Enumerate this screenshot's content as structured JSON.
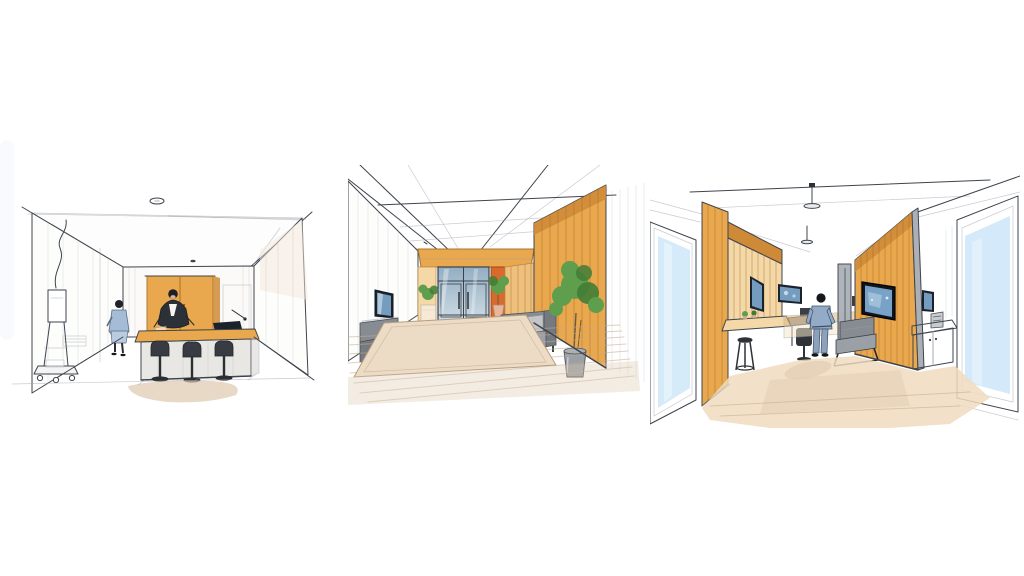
{
  "artwork": {
    "type": "hand-drawn interior concept sketch triptych",
    "medium": "ink line drawing with watercolor wash",
    "background": "#ffffff",
    "panels": [
      {
        "name": "consultation-room",
        "elements": [
          "recessed ceiling light",
          "orange wall cabinet",
          "wood-top reception desk",
          "three dark bar stools",
          "seated person in dark jacket",
          "standing visitor in blue coat",
          "mobile equipment stand with wheels and cable",
          "warm floor shadow wash"
        ]
      },
      {
        "name": "entrance-lobby",
        "elements": [
          "one-point ceiling grid",
          "wood entry portal",
          "blue glass double door",
          "orange accent panel",
          "orange wood feature wall",
          "wall-mounted tv",
          "gray bench",
          "side table",
          "pedestal plant",
          "floor plant",
          "gray sofa with white cushions",
          "tall potted plant",
          "beige area rug",
          "wood plank floor"
        ]
      },
      {
        "name": "gallery-corridor",
        "elements": [
          "left window with sky wash",
          "wood pillar",
          "slat wall with inset screen",
          "counter with stool",
          "desk with chair",
          "back-wall display screen",
          "wood credenza",
          "gray door pillar",
          "right wood slat wall",
          "large wall display",
          "small framed display",
          "gray bench",
          "white cabinet with device",
          "right window with sky wash",
          "two pendant lights",
          "walking person in blue",
          "beige floor wash with cast shadow"
        ]
      }
    ]
  },
  "colors": {
    "ink": "#3f444d",
    "wood_orange": "#e9a84e",
    "wood_deep": "#cf8a38",
    "wood_light": "#eec07e",
    "wood_pale": "#f4d8a8",
    "accent_orange": "#d96a2e",
    "floor_beige": "#f0dcbe",
    "floor_stroke": "#c9ab8c",
    "rug_beige": "#ecdcc5",
    "glass_blue": "#a3bccd",
    "sky_blue": "#cfe8f9",
    "screen_blue": "#78a3c6",
    "screen_dark": "#1c222b",
    "person_blue": "#a4bcd6",
    "person_dark": "#2c3037",
    "furniture_gray": "#878c93",
    "cushion_white": "#f5f5f2",
    "plant_green": "#5f9e4c",
    "plant_green_dark": "#417c36",
    "metal_gray": "#aab0b6",
    "shadow_warm": "#ddc9ae"
  }
}
